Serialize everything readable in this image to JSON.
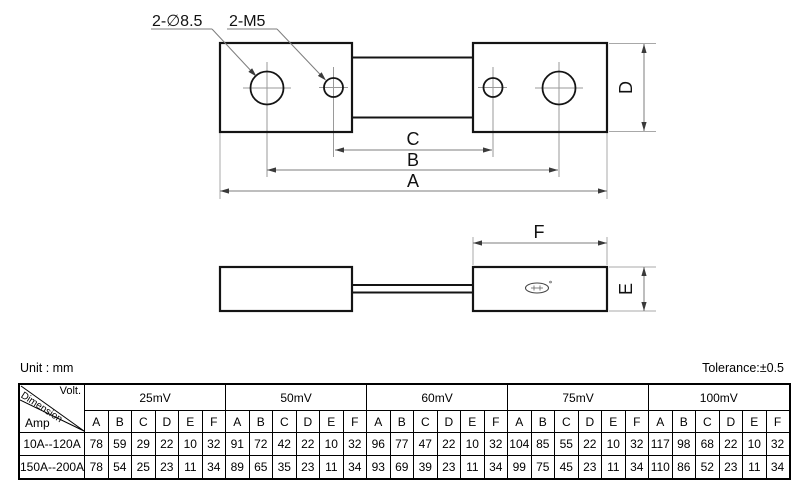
{
  "notes": {
    "unit": "Unit : mm",
    "tolerance": "Tolerance:±0.5"
  },
  "drawing": {
    "colors": {
      "outline": "#141414",
      "dimension_line": "#7d7d7d",
      "extension_line": "#a8a8a8",
      "arrowhead": "#3a3a3a",
      "text": "#111111"
    },
    "top_view": {
      "hole_label_diameter": "2-∅8.5",
      "hole_label_thread": "2-M5",
      "dim_inner_hole_spacing": "C",
      "dim_outer_hole_spacing": "B",
      "dim_overall_length": "A",
      "dim_block_width": "D"
    },
    "side_view": {
      "dim_block_length": "F",
      "dim_block_thickness": "E"
    }
  },
  "table": {
    "corner": {
      "top_right": "Volt.",
      "diagonal": "Dimension",
      "bottom_left": "Amp"
    },
    "sub_headers": [
      "A",
      "B",
      "C",
      "D",
      "E",
      "F"
    ],
    "groups": [
      {
        "label": "25mV"
      },
      {
        "label": "50mV"
      },
      {
        "label": "60mV"
      },
      {
        "label": "75mV"
      },
      {
        "label": "100mV"
      }
    ],
    "rows": [
      {
        "label": "10A--120A",
        "values": [
          [
            78,
            59,
            29,
            22,
            10,
            32
          ],
          [
            91,
            72,
            42,
            22,
            10,
            32
          ],
          [
            96,
            77,
            47,
            22,
            10,
            32
          ],
          [
            104,
            85,
            55,
            22,
            10,
            32
          ],
          [
            117,
            98,
            68,
            22,
            10,
            32
          ]
        ]
      },
      {
        "label": "150A--200A",
        "values": [
          [
            78,
            54,
            25,
            23,
            11,
            34
          ],
          [
            89,
            65,
            35,
            23,
            11,
            34
          ],
          [
            93,
            69,
            39,
            23,
            11,
            34
          ],
          [
            99,
            75,
            45,
            23,
            11,
            34
          ],
          [
            110,
            86,
            52,
            23,
            11,
            34
          ]
        ]
      }
    ]
  }
}
